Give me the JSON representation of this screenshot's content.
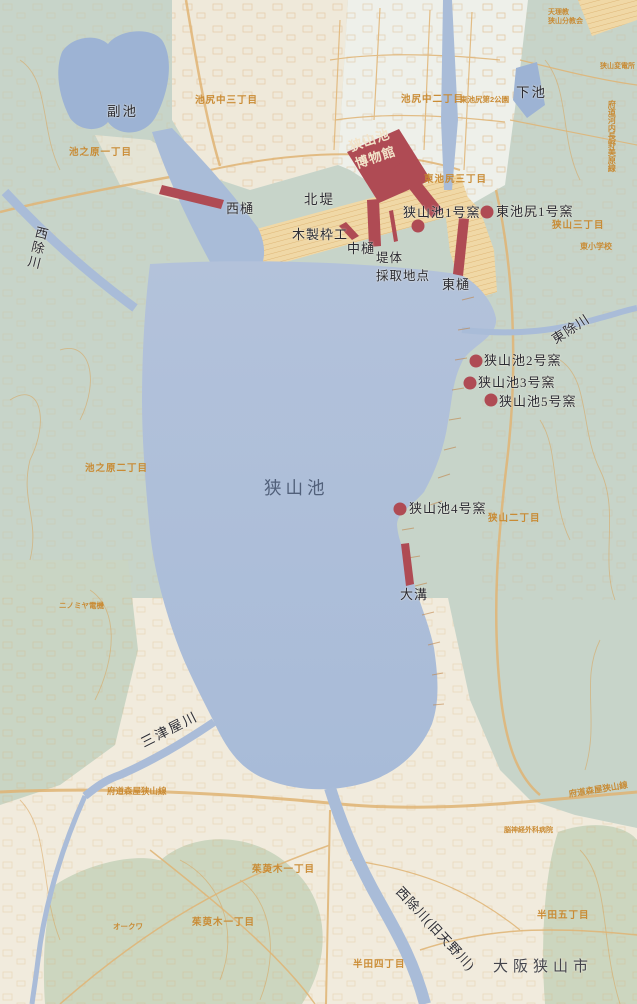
{
  "map": {
    "region": "狭山池周辺図",
    "colors": {
      "water": "#abbdd8",
      "pond": "#9db3d4",
      "land_green": "#c7d4c9",
      "land_cream": "#f1ebdd",
      "land_pale": "#eef0eb",
      "dike_tan": "#f0d8a6",
      "accent_red": "#af4b54",
      "contour_orange": "#d9a258",
      "label_orange": "#c9882e",
      "label_dark": "#2b2b33",
      "lake_label": "#51607a"
    },
    "labels": {
      "lake": "狭山池",
      "sub_pond": "副池",
      "shimo_pond": "下池",
      "north_dike": "北堤",
      "west_sluice": "西樋",
      "wooden_frame": "木製枠工",
      "middle_sluice": "中樋",
      "embankment_sampling": "堤体\n採取地点",
      "east_sluice": "東樋",
      "museum": "狭山池\n博物館",
      "kiln1": "狭山池1号窯",
      "higashi_ikejiri_kiln1": "東池尻1号窯",
      "kiln2": "狭山池2号窯",
      "kiln3": "狭山池3号窯",
      "kiln5": "狭山池5号窯",
      "kiln4": "狭山池4号窯",
      "omizo": "大溝",
      "nishiyoke_river": "西除川",
      "higashiyoke_river": "東除川",
      "mitsuya_river": "三津屋川",
      "nishiyoke_old": "西除川(旧天野川)",
      "city": "大阪狭山市"
    },
    "minor_labels": {
      "ikejiri_naka3": "池尻中三丁目",
      "ikejiri_naka2": "池尻中二丁目",
      "higashi_ikejiri_park": "東池尻第2公園",
      "ikenohara1": "池之原一丁目",
      "higashi_ikejiri3": "東池尻三丁目",
      "sayama3": "狭山三丁目",
      "higashi_elementary": "東小学校",
      "ikenohara2": "池之原二丁目",
      "sayama2": "狭山二丁目",
      "substation": "狭山変電所",
      "pref_road_kawachi": "府道河内長野美原線",
      "moriya_road_west": "府道森屋狭山線",
      "moriya_road_east": "府道森屋狭山線",
      "kuminoki1_north": "茱萸木一丁目",
      "kuminoki1_south": "茱萸木一丁目",
      "handa5": "半田五丁目",
      "handa4": "半田四丁目",
      "ninomiya": "ニノミヤ電機",
      "okuwa": "オークワ",
      "hospital": "脳神経外科病院",
      "tenrikyo": "天理教\n狭山分教会"
    }
  }
}
